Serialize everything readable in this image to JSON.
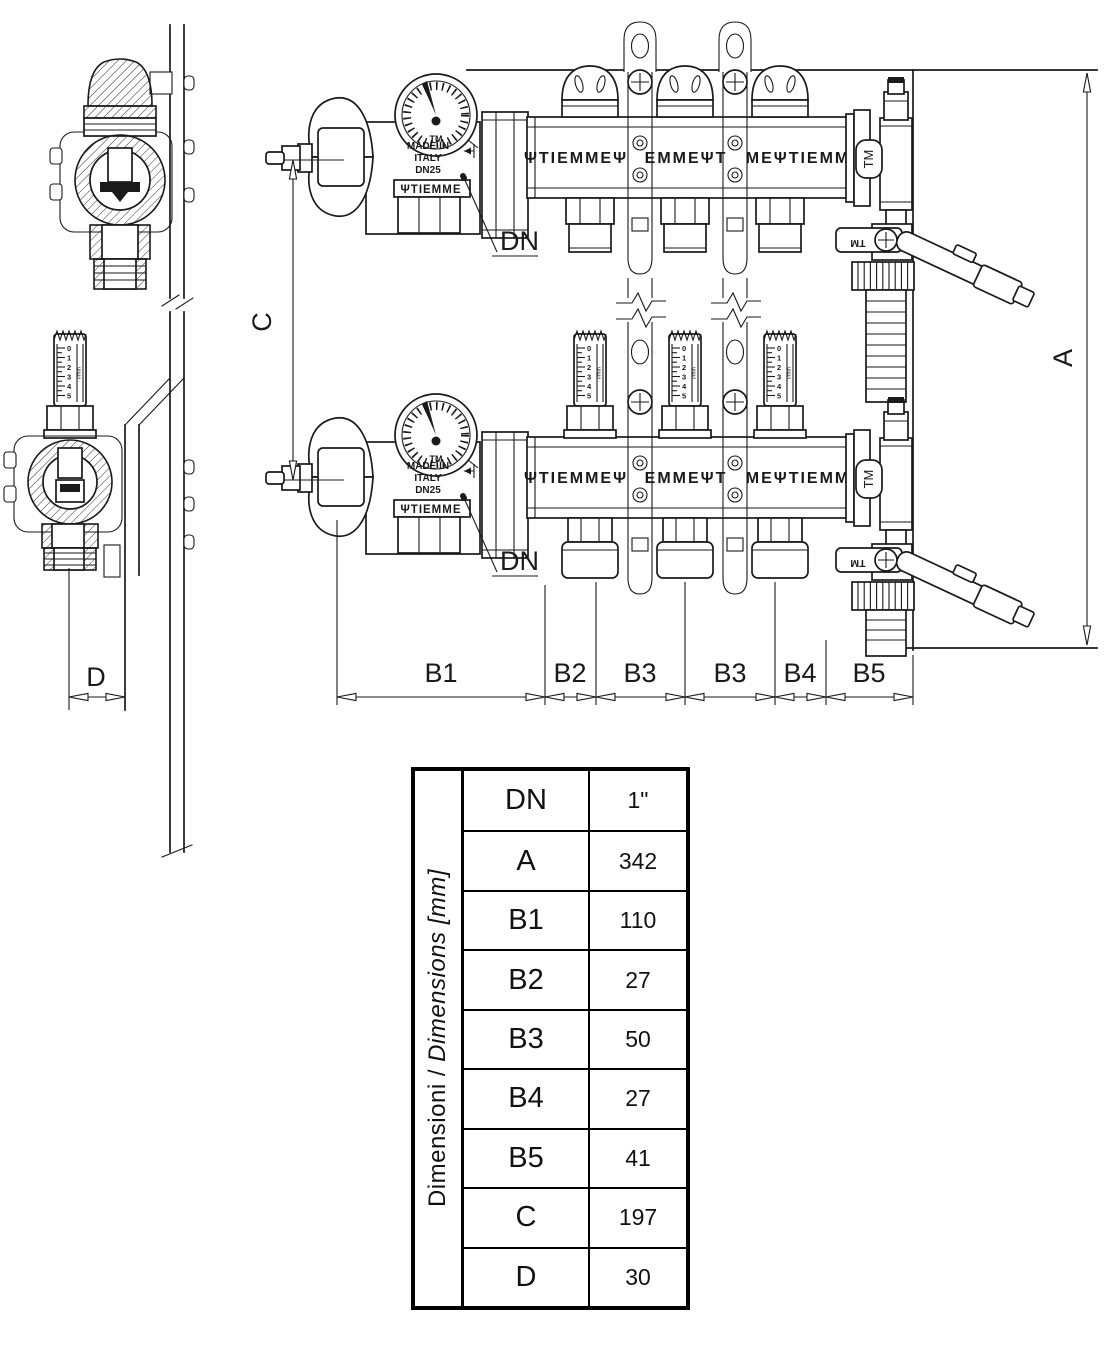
{
  "drawing": {
    "dimensions": {
      "c": "C",
      "a": "A",
      "d": "D",
      "dn_callout": "DN",
      "b_chain": [
        "B1",
        "B2",
        "B3",
        "B3",
        "B4",
        "B5"
      ]
    },
    "labels": {
      "gauge_tm": "TM",
      "made_in": "MADE IN",
      "italy": "ITALY",
      "dn_size": "DN25",
      "brand_band": "ΨTIEMME",
      "manifold_segment_1": "ΨTIEMMEΨ",
      "manifold_segment_2": "EMMEΨT",
      "manifold_segment_3": "MEΨTIEMM",
      "end_cap_tm": "TM",
      "lever_tm": "TM"
    },
    "flow_meter": {
      "scale": [
        "0",
        "1",
        "2",
        "3",
        "4",
        "5"
      ],
      "unit": "l/min"
    }
  },
  "table": {
    "header_primary": "Dimensioni / ",
    "header_secondary": "Dimensions [mm]",
    "rows": [
      {
        "label": "DN",
        "value": "1\""
      },
      {
        "label": "A",
        "value": "342"
      },
      {
        "label": "B1",
        "value": "110"
      },
      {
        "label": "B2",
        "value": "27"
      },
      {
        "label": "B3",
        "value": "50"
      },
      {
        "label": "B4",
        "value": "27"
      },
      {
        "label": "B5",
        "value": "41"
      },
      {
        "label": "C",
        "value": "197"
      },
      {
        "label": "D",
        "value": "30"
      }
    ]
  }
}
